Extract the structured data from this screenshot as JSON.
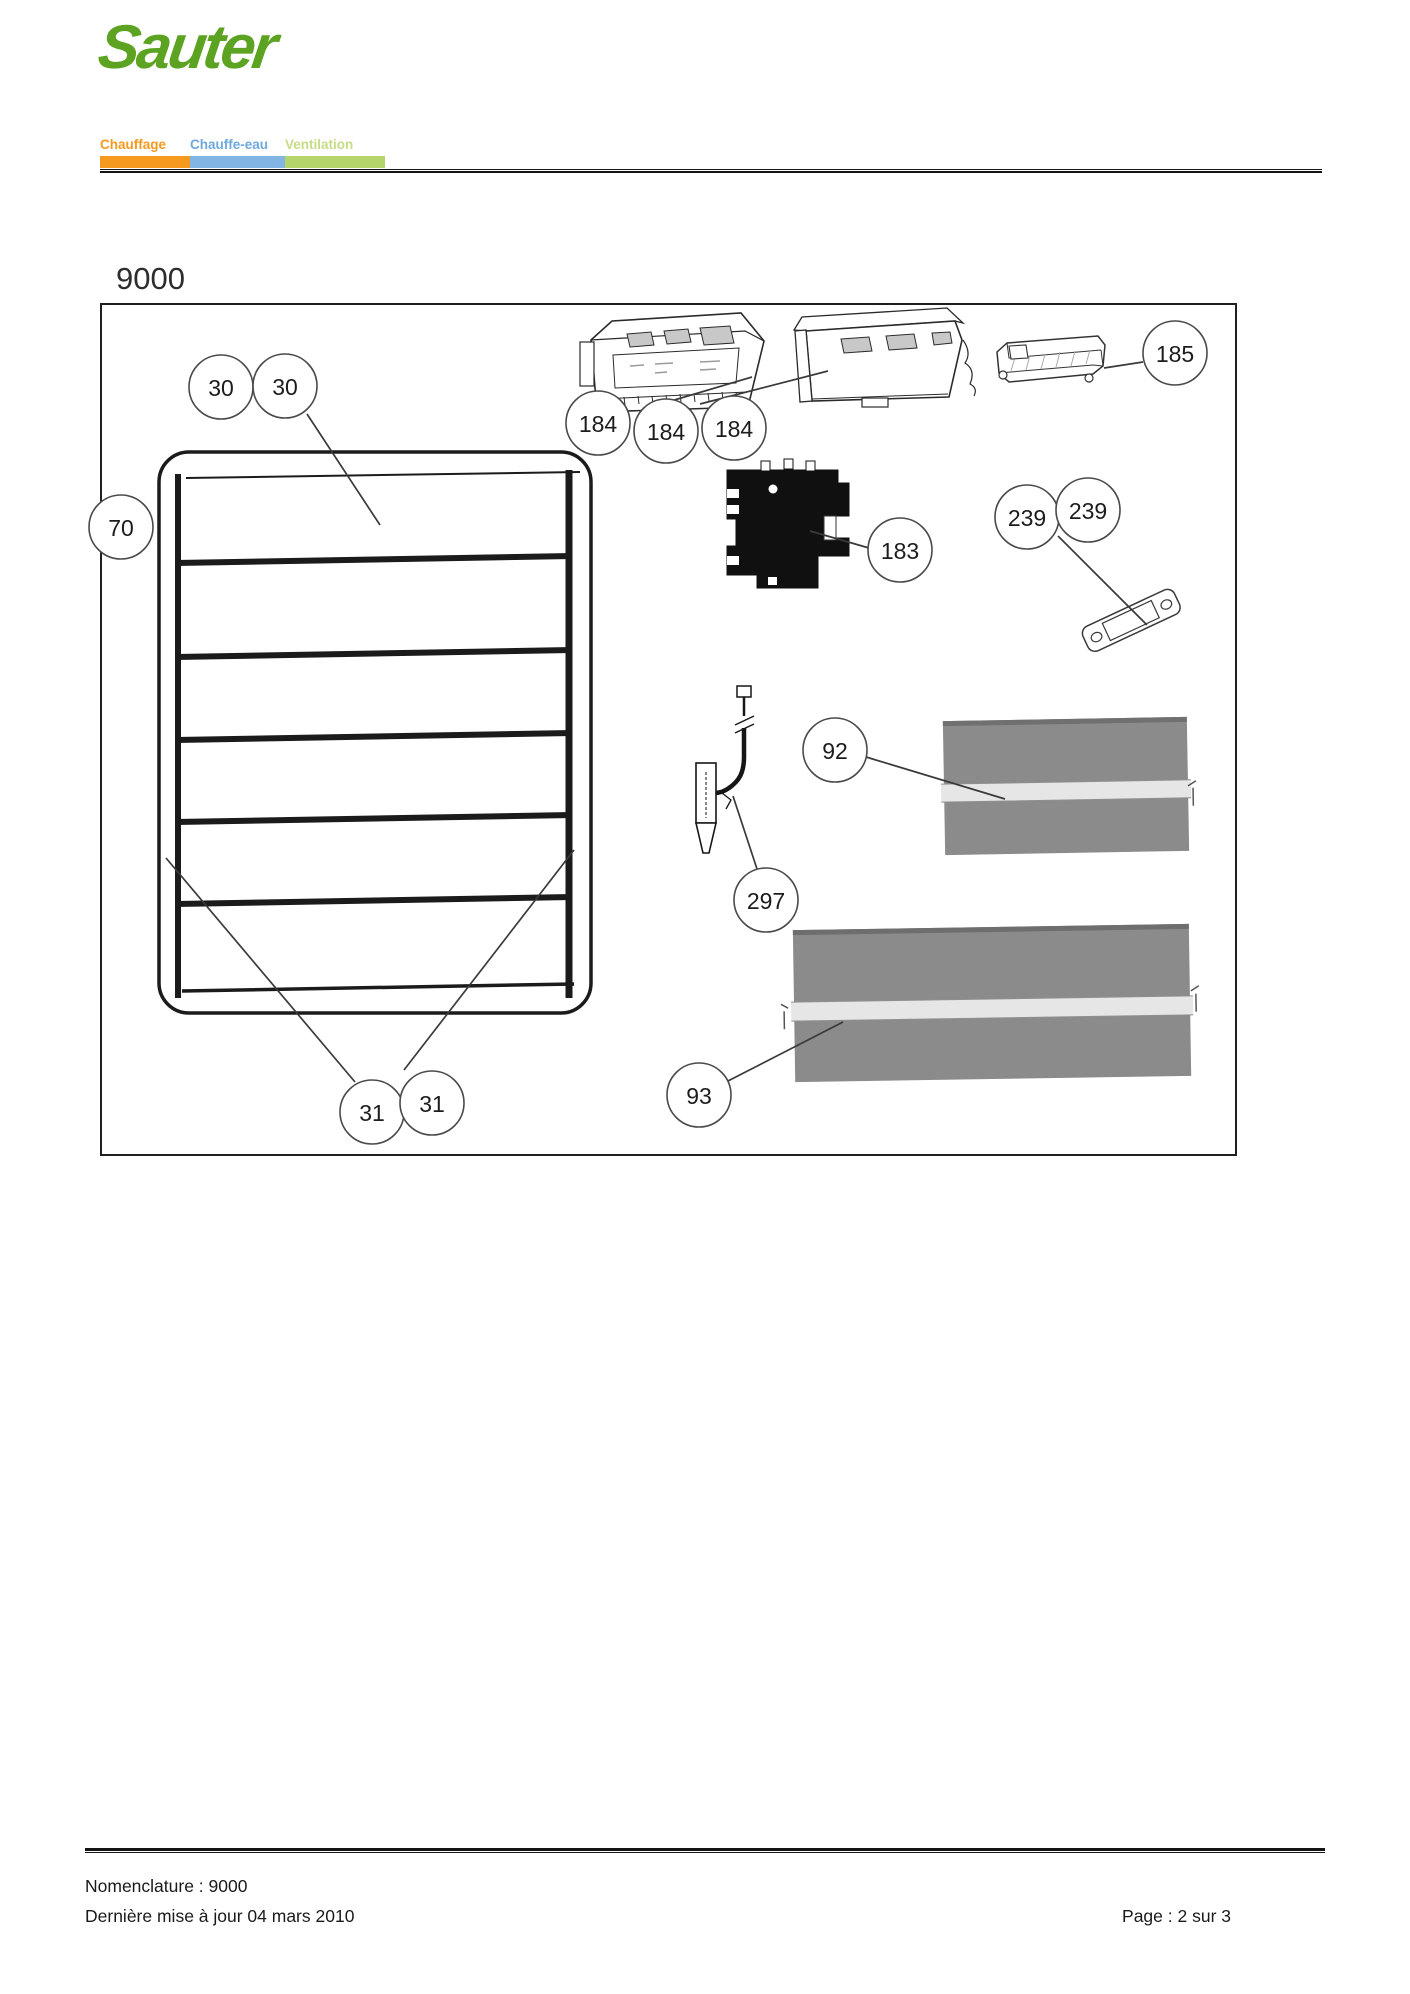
{
  "header": {
    "logo_text": "Sauter",
    "logo_color": "#5CA322",
    "nav_items": [
      {
        "label": "Chauffage",
        "text_color": "#F5991F",
        "bar_color": "#F5991F",
        "bar_width": 90
      },
      {
        "label": "Chauffe-eau",
        "text_color": "#6FA8DC",
        "bar_color": "#82B4E4",
        "bar_width": 95
      },
      {
        "label": "Ventilation",
        "text_color": "#C6DC85",
        "bar_color": "#B4D56A",
        "bar_width": 100
      }
    ]
  },
  "diagram": {
    "title": "9000",
    "callout_radius": 32,
    "callouts": [
      {
        "label": "30",
        "x": 221,
        "y": 387
      },
      {
        "label": "30",
        "x": 285,
        "y": 386
      },
      {
        "label": "70",
        "x": 121,
        "y": 527
      },
      {
        "label": "184",
        "x": 598,
        "y": 423
      },
      {
        "label": "184",
        "x": 666,
        "y": 431
      },
      {
        "label": "184",
        "x": 734,
        "y": 428
      },
      {
        "label": "185",
        "x": 1175,
        "y": 353
      },
      {
        "label": "183",
        "x": 900,
        "y": 550
      },
      {
        "label": "239",
        "x": 1027,
        "y": 517
      },
      {
        "label": "239",
        "x": 1088,
        "y": 510
      },
      {
        "label": "92",
        "x": 835,
        "y": 750
      },
      {
        "label": "297",
        "x": 766,
        "y": 900
      },
      {
        "label": "93",
        "x": 699,
        "y": 1095
      },
      {
        "label": "31",
        "x": 372,
        "y": 1112
      },
      {
        "label": "31",
        "x": 432,
        "y": 1103
      }
    ],
    "leaders": [
      {
        "x1": 307,
        "y1": 414,
        "x2": 380,
        "y2": 525
      },
      {
        "x1": 166,
        "y1": 858,
        "x2": 355,
        "y2": 1082
      },
      {
        "x1": 574,
        "y1": 850,
        "x2": 404,
        "y2": 1070
      },
      {
        "x1": 671,
        "y1": 401,
        "x2": 752,
        "y2": 377
      },
      {
        "x1": 700,
        "y1": 404,
        "x2": 828,
        "y2": 371
      },
      {
        "x1": 1143,
        "y1": 362,
        "x2": 1104,
        "y2": 368
      },
      {
        "x1": 869,
        "y1": 548,
        "x2": 810,
        "y2": 531
      },
      {
        "x1": 1058,
        "y1": 536,
        "x2": 1147,
        "y2": 625
      },
      {
        "x1": 866,
        "y1": 757,
        "x2": 1005,
        "y2": 799
      },
      {
        "x1": 733,
        "y1": 796,
        "x2": 757,
        "y2": 869
      },
      {
        "x1": 726,
        "y1": 1082,
        "x2": 843,
        "y2": 1022
      }
    ]
  },
  "footer": {
    "nomenclature": "Nomenclature : 9000",
    "last_update": "Dernière mise à jour 04 mars 2010",
    "page": "Page : 2 sur 3"
  }
}
